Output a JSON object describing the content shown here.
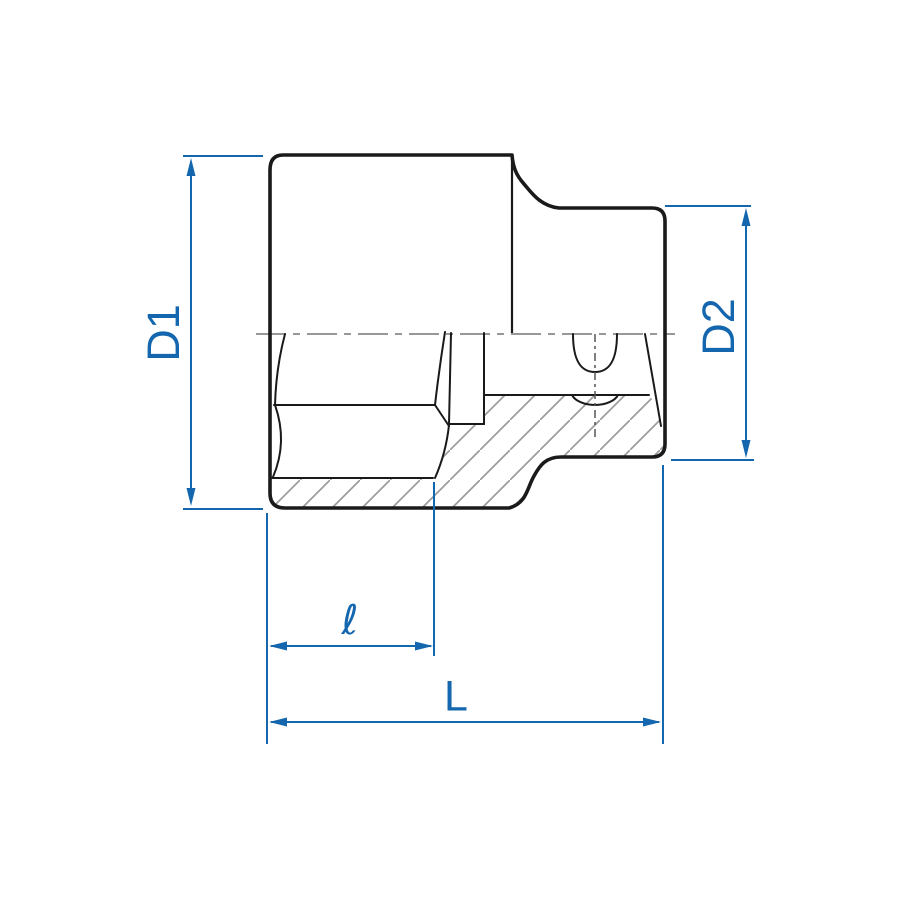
{
  "drawing": {
    "title": "socket cross-section technical drawing",
    "background": "#ffffff",
    "outline_color": "#1a1a1a",
    "hatch_color": "#9c9c9c",
    "centerline_color": "#8a8a8a",
    "dimension_color": "#1467ae",
    "labels": {
      "d1": "D1",
      "d2": "D2",
      "ell": "ℓ",
      "length": "L"
    }
  }
}
